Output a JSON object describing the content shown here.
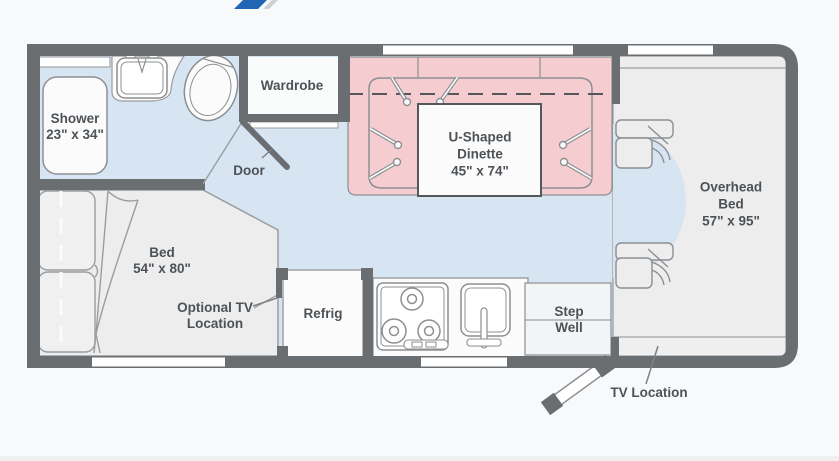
{
  "title": "RV floor plan",
  "colors": {
    "wall": "#6a6e71",
    "floor_blue": "#d7e5f3",
    "slideout_pink": "#f5cdd1",
    "furniture_gray": "#ededee",
    "fixture_white": "#fbfbfc",
    "outline": "#8c8f91",
    "text": "#4d5256",
    "logo_blue": "#2066b4"
  },
  "labels": {
    "shower": {
      "name": "Shower",
      "dimensions": "23\" x 34\""
    },
    "wardrobe": {
      "name": "Wardrobe"
    },
    "door": {
      "name": "Door"
    },
    "dinette": {
      "line1": "U-Shaped",
      "line2": "Dinette",
      "dimensions": "45\" x 74\""
    },
    "overhead_bed": {
      "line1": "Overhead",
      "line2": "Bed",
      "dimensions": "57\" x 95\""
    },
    "bed": {
      "name": "Bed",
      "dimensions": "54\" x 80\""
    },
    "optional_tv": {
      "line1": "Optional TV",
      "line2": "Location"
    },
    "refrig": {
      "name": "Refrig"
    },
    "step_well": {
      "line1": "Step",
      "line2": "Well"
    },
    "tv_location": {
      "name": "TV Location"
    }
  }
}
